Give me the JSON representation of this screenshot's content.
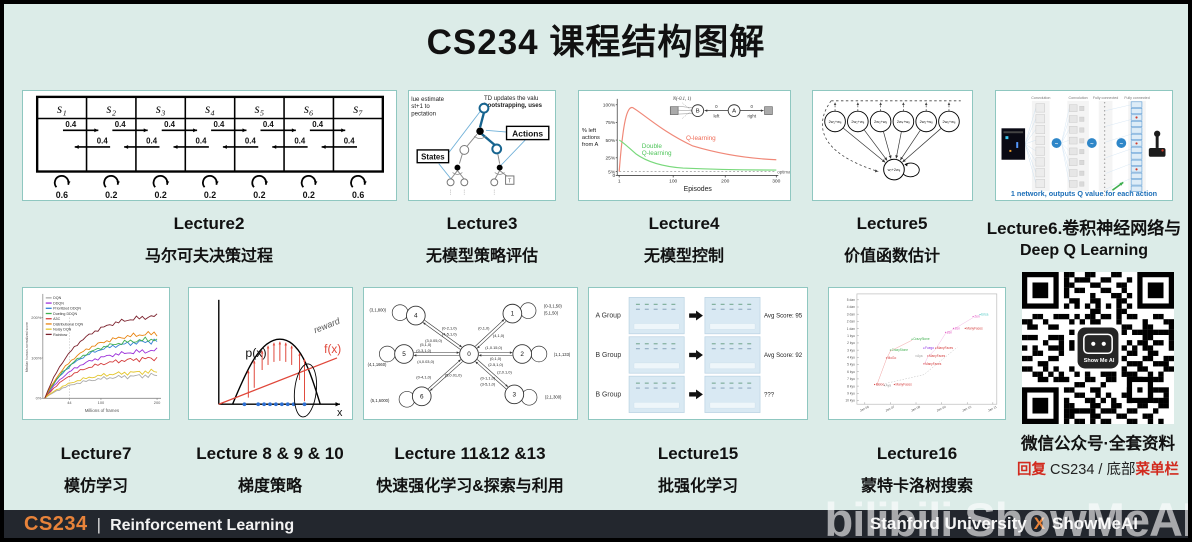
{
  "page": {
    "title": "CS234 课程结构图解"
  },
  "colors": {
    "background": "#dcece8",
    "thumb_border": "#8fc7c0",
    "footer_bg": "#23272e",
    "accent_orange": "#e8833a",
    "accent_red": "#d22a1e",
    "annotation_blue": "#1d6fb8"
  },
  "lectures": [
    {
      "title": "Lecture2",
      "subtitle": "马尔可夫决策过程"
    },
    {
      "title": "Lecture3",
      "subtitle": "无模型策略评估"
    },
    {
      "title": "Lecture4",
      "subtitle": "无模型控制"
    },
    {
      "title": "Lecture5",
      "subtitle": "价值函数估计"
    },
    {
      "title": "Lecture6.卷积神经网络与",
      "subtitle": "Deep Q Learning"
    },
    {
      "title": "Lecture7",
      "subtitle": "模仿学习"
    },
    {
      "title": "Lecture 8 & 9 & 10",
      "subtitle": "梯度策略"
    },
    {
      "title": "Lecture 11&12 &13",
      "subtitle": "快速强化学习&探索与利用"
    },
    {
      "title": "Lecture15",
      "subtitle": "批强化学习"
    },
    {
      "title": "Lecture16",
      "subtitle": "蒙特卡洛树搜索"
    }
  ],
  "thumbnails": {
    "markov": {
      "states": [
        "s₁",
        "s₂",
        "s₃",
        "s₄",
        "s₅",
        "s₆",
        "s₇"
      ],
      "forward_prob": "0.4",
      "backward_prob": "0.4",
      "self_probs": [
        "0.6",
        "0.2",
        "0.2",
        "0.2",
        "0.2",
        "0.2",
        "0.6"
      ]
    },
    "td_tree": {
      "left_note": [
        "lue estimate",
        "st+1 to",
        "pectation"
      ],
      "right_note": [
        "TD updates the valu",
        "bootstrapping, uses"
      ],
      "states_label": "States",
      "actions_label": "Actions",
      "terminal_label": "T"
    },
    "qlearning": {
      "ylabel": [
        "% left",
        "actions",
        "from A"
      ],
      "yticks": [
        "100%",
        "75%",
        "50%",
        "25%",
        "5%",
        "0"
      ],
      "xticks": [
        "1",
        "100",
        "200",
        "300"
      ],
      "xlabel": "Episodes",
      "series1": "Q-learning",
      "series2": [
        "Double",
        "Q-learning"
      ],
      "optimal": "optimal",
      "inset_dist": "N(-0.1, 1)",
      "inset_nodes": [
        "B",
        "A"
      ],
      "inset_edge_labels": [
        "0",
        "left",
        "0",
        "right"
      ]
    },
    "baird": {
      "upper_labels": [
        "2w₁+w₈",
        "2w₂+w₈",
        "2w₃+w₈",
        "2w₄+w₈",
        "2w₅+w₈",
        "2w₆+w₈"
      ],
      "lower_label": "w₇+2w₈"
    },
    "dqn": {
      "headers": [
        "Convolution",
        "Convolution",
        "Fully connected",
        "Fully connected"
      ],
      "caption": "1 network, outputs Q value for each action"
    },
    "rainbow": {
      "legend": [
        "DQN",
        "DDQN",
        "Prioritized DDQN",
        "Dueling DDQN",
        "A3C",
        "Distributional DQN",
        "Noisy DQN",
        "Rainbow"
      ],
      "legend_colors": [
        "#aaaaaa",
        "#9b30d9",
        "#2f7fd4",
        "#3faf4e",
        "#d43a3a",
        "#e8820c",
        "#e3c52a",
        "#7a1f2b"
      ],
      "ylabel": "Median human-normalized score",
      "yticks": [
        "200%",
        "100%",
        "0%"
      ],
      "xticks": [
        "44",
        "100",
        "200"
      ],
      "xlabel": "Millions of frames"
    },
    "policy_gradient": {
      "p_label": "p(x)",
      "f_label": "f(x)",
      "x_label": "x",
      "annotation": "reward"
    },
    "explore_mdp": {
      "nodes": [
        "0",
        "1",
        "2",
        "3",
        "4",
        "5",
        "6"
      ],
      "outer_labels": [
        "(0-3,1,50)",
        "(5,1,50)",
        "(1,1,133)",
        "(2,1,300)",
        "(3,1,800)",
        "(4,1,1660)",
        "(5,1,6000)"
      ],
      "edge_labels": [
        "(0,1,0)",
        "(4,1,0)",
        "(1,0.15,0)",
        "(0,1,0)",
        "(2-5,1,0)",
        "(0-1,1,0)",
        "(3-5,1,0)",
        "(2,0.1,0)",
        "(0-2,1,0)",
        "(4-5,1,0)",
        "(3,0.05,0)",
        "(5,1,0)",
        "(0-3,1,0)",
        "(4,0.03,0)",
        "(0-4,1,0)",
        "(5,0.01,0)"
      ]
    },
    "batch_rl": {
      "rows": [
        {
          "group": "A Group",
          "score": "Avg Score: 95"
        },
        {
          "group": "B Group",
          "score": "Avg Score: 92"
        },
        {
          "group": "B Group",
          "score": "???"
        }
      ]
    },
    "mcts": {
      "yticks": [
        "5 dan",
        "4 dan",
        "3 dan",
        "2 dan",
        "1 dan",
        "1 kyu",
        "2 kyu",
        "3 kyu",
        "4 kyu",
        "5 kyu",
        "6 kyu",
        "7 kyu",
        "8 kyu",
        "9 kyu",
        "10 kyu"
      ],
      "xticks": [
        "Jan 06",
        "Jan 07",
        "Jan 08",
        "Jan 09",
        "Jan 10",
        "Jan 11"
      ],
      "programs": [
        {
          "name": "MoGo",
          "color": "#d43a3a"
        },
        {
          "name": "CrazyStone",
          "color": "#3faf4e"
        },
        {
          "name": "ManyFaces",
          "color": "#d43a3a"
        },
        {
          "name": "Fuego",
          "color": "#8a2be2"
        },
        {
          "name": "Aya",
          "color": "#999999"
        },
        {
          "name": "Zen",
          "color": "#e052c2"
        },
        {
          "name": "Erica",
          "color": "#49c7c2"
        }
      ]
    },
    "qr": {
      "caption": "微信公众号·全套资料",
      "reply_prefix": "回复",
      "reply_mid": " CS234 / 底部",
      "reply_suffix": "菜单栏",
      "logo_text": "Show Me AI"
    }
  },
  "footer": {
    "course_code": "CS234",
    "divider": "|",
    "course_name": "Reinforcement Learning",
    "university": "Stanford University",
    "collab_x": "X",
    "brand": "ShowMeAI",
    "watermark": "bilibili ShowMeAI"
  }
}
